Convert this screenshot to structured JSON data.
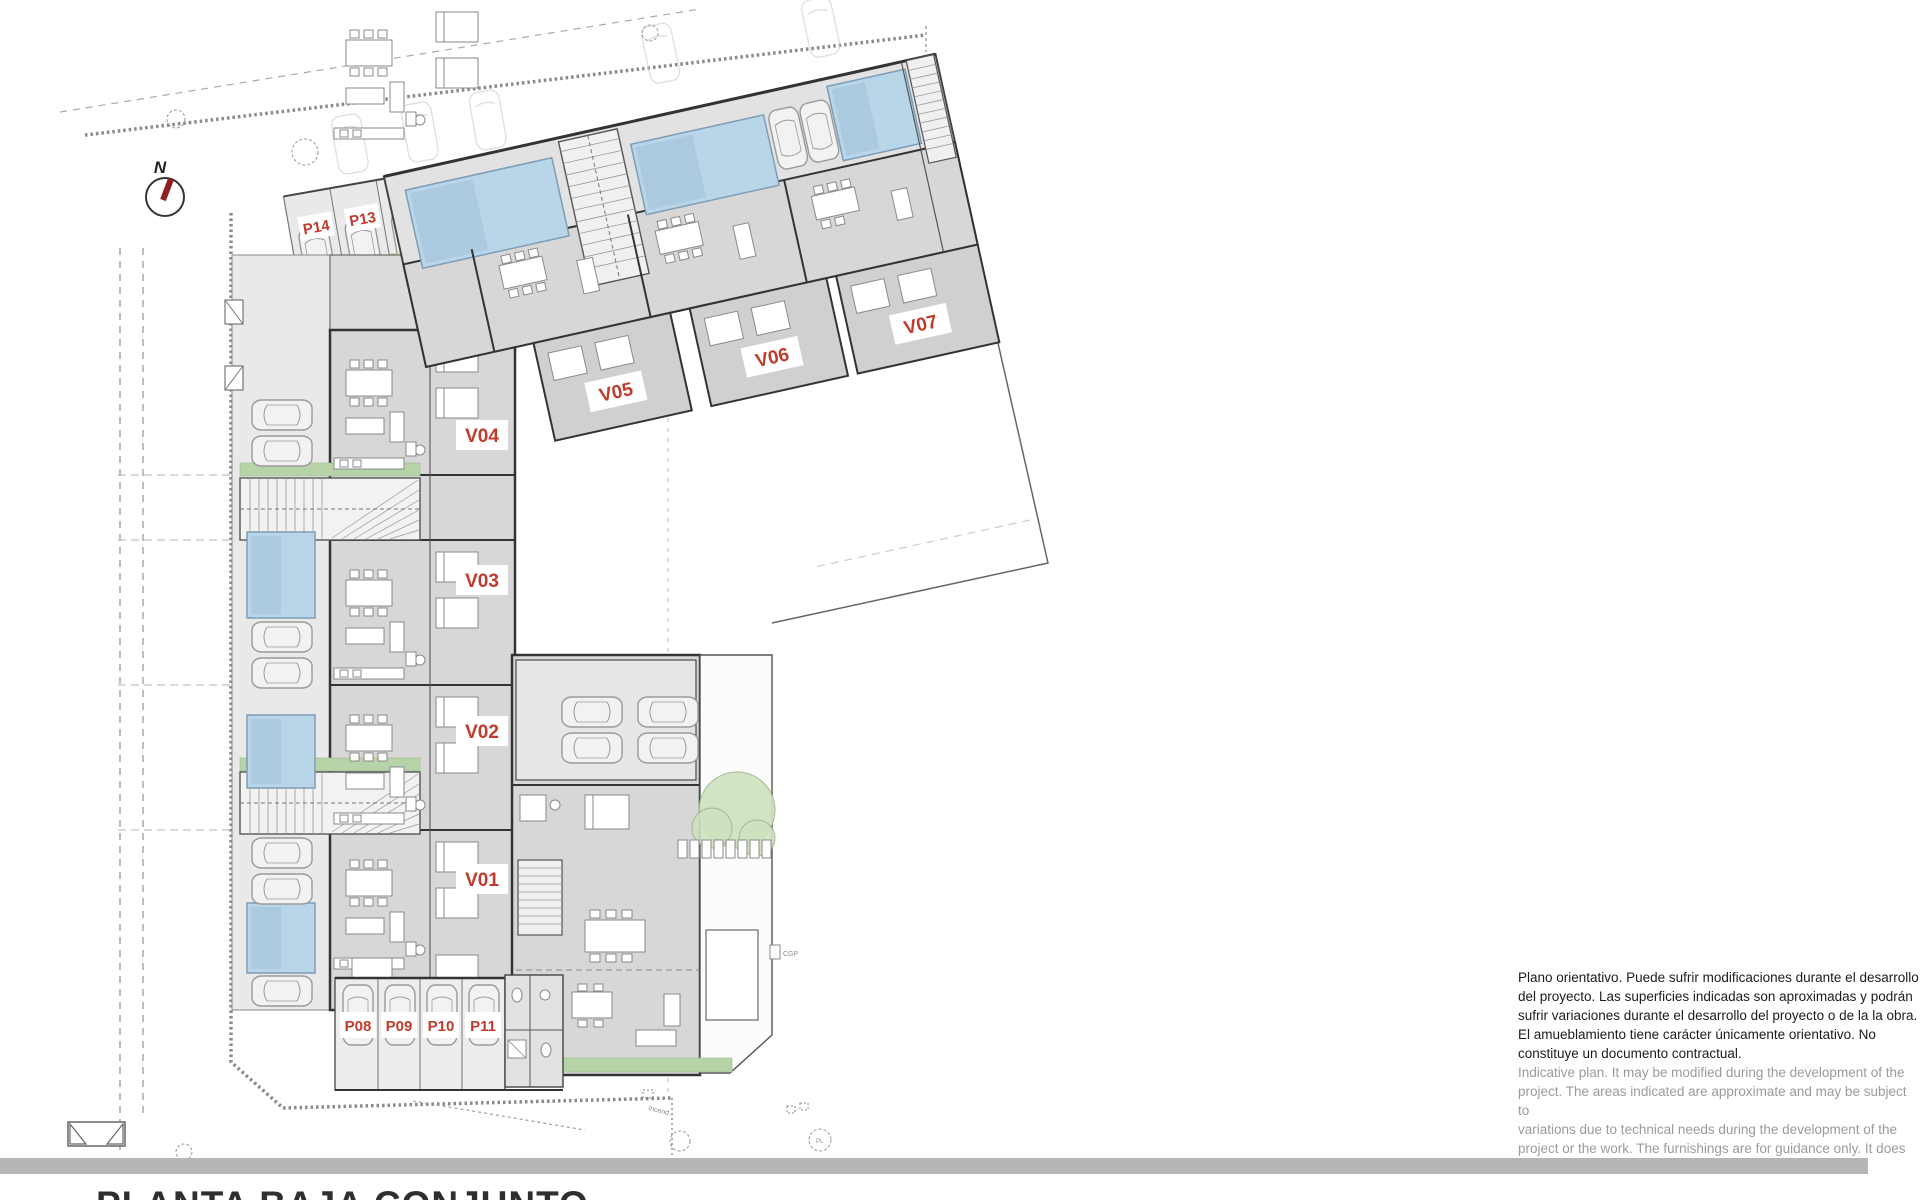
{
  "title_block": {
    "title": "PLANTA BAJA CONJUNTO"
  },
  "compass": {
    "label": "N"
  },
  "units": [
    {
      "id": "V01"
    },
    {
      "id": "V02"
    },
    {
      "id": "V03"
    },
    {
      "id": "V04"
    },
    {
      "id": "V05"
    },
    {
      "id": "V06"
    },
    {
      "id": "V07"
    }
  ],
  "parking": [
    {
      "id": "P08"
    },
    {
      "id": "P09"
    },
    {
      "id": "P10"
    },
    {
      "id": "P11"
    },
    {
      "id": "P12"
    },
    {
      "id": "P13"
    },
    {
      "id": "P14"
    }
  ],
  "site_annotations": {
    "cgp": "CGP",
    "incend": "Incend.",
    "pl": "PL"
  },
  "disclaimer": {
    "spanish_lines": [
      "Plano orientativo. Puede sufrir modificaciones durante el desarrollo",
      "del proyecto. Las superficies indicadas son aproximadas y podrán",
      "sufrir variaciones durante el desarrollo del proyecto o de la la obra.",
      "El amueblamiento tiene carácter únicamente orientativo. No",
      "constituye un documento contractual."
    ],
    "english_lines": [
      "Indicative plan. It may be modified during the development of the",
      "project. The areas indicated are approximate and may be subject to",
      "variations due to technical needs during the development of the",
      "project or the work. The furnishings are for guidance only. It does",
      "not constitute a contractual document."
    ]
  },
  "colors": {
    "label_red": "#c23a2c",
    "pool_blue": "#b9d5e8",
    "pool_blue_dark": "#a7c7dd",
    "green_area": "#d5e6cb",
    "green_strip": "#b7d3a8",
    "building_gray": "#d7d7d7",
    "bar_gray": "#b6b6b6"
  }
}
